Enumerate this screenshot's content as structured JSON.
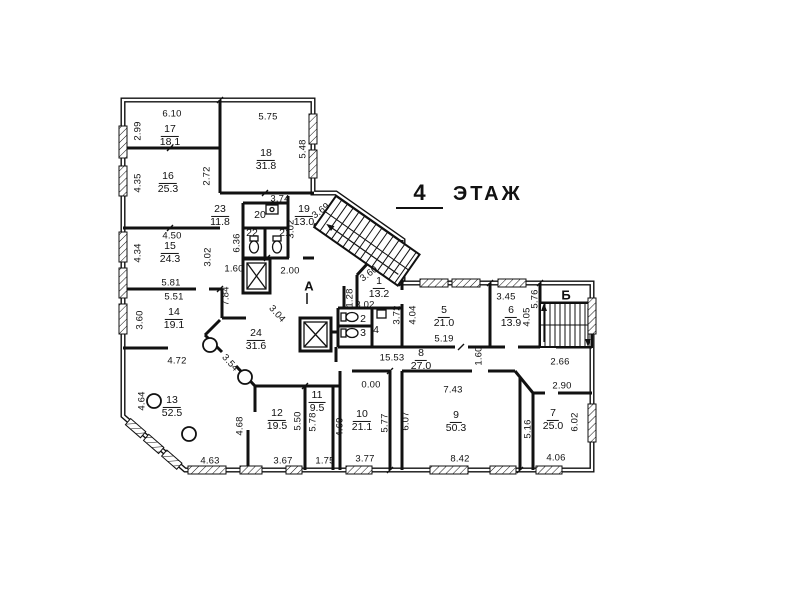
{
  "title": {
    "floor_number": "4",
    "floor_word": "ЭТАЖ"
  },
  "axes": {
    "stair_a": "А",
    "stair_b": "Б"
  },
  "colors": {
    "ink": "#111111",
    "paper": "#ffffff"
  },
  "rooms": [
    {
      "num": "17",
      "area": "18.1"
    },
    {
      "num": "18",
      "area": "31.8"
    },
    {
      "num": "16",
      "area": "25.3"
    },
    {
      "num": "15",
      "area": "24.3"
    },
    {
      "num": "14",
      "area": "19.1"
    },
    {
      "num": "13",
      "area": "52.5"
    },
    {
      "num": "23",
      "area": "11.8"
    },
    {
      "num": "19",
      "area": "13.0"
    },
    {
      "num": "24",
      "area": "31.6"
    },
    {
      "num": "1",
      "area": "13.2"
    },
    {
      "num": "5",
      "area": "21.0"
    },
    {
      "num": "6",
      "area": "13.9"
    },
    {
      "num": "8",
      "area": "27.0"
    },
    {
      "num": "12",
      "area": "19.5"
    },
    {
      "num": "11",
      "area": "9.5"
    },
    {
      "num": "10",
      "area": "21.1"
    },
    {
      "num": "9",
      "area": "50.3"
    },
    {
      "num": "7",
      "area": "25.0"
    }
  ],
  "small_rooms": [
    "20",
    "22",
    "21",
    "2",
    "3",
    "4"
  ],
  "dims": [
    "6.10",
    "2.99",
    "5.75",
    "5.48",
    "4.35",
    "2.72",
    "3.74",
    "3.02",
    "3.69",
    "6.36",
    "4.50",
    "4.34",
    "3.02",
    "1.60",
    "2.00",
    "5.81",
    "5.51",
    "7.84",
    "3.60",
    "3.04",
    "4.72",
    "3.54",
    "4.64",
    "4.68",
    "5.50",
    "5.78",
    "4.63",
    "3.67",
    "1.75",
    "4.69",
    "3.77",
    "5.77",
    "6.07",
    "0.00",
    "7.43",
    "8.42",
    "5.16",
    "6.02",
    "4.06",
    "2.90",
    "2.66",
    "15.53",
    "1.60",
    "5.19",
    "4.04",
    "3.72",
    "3.45",
    "4.05",
    "5.76",
    "1.28",
    "3.02",
    "3.60"
  ]
}
